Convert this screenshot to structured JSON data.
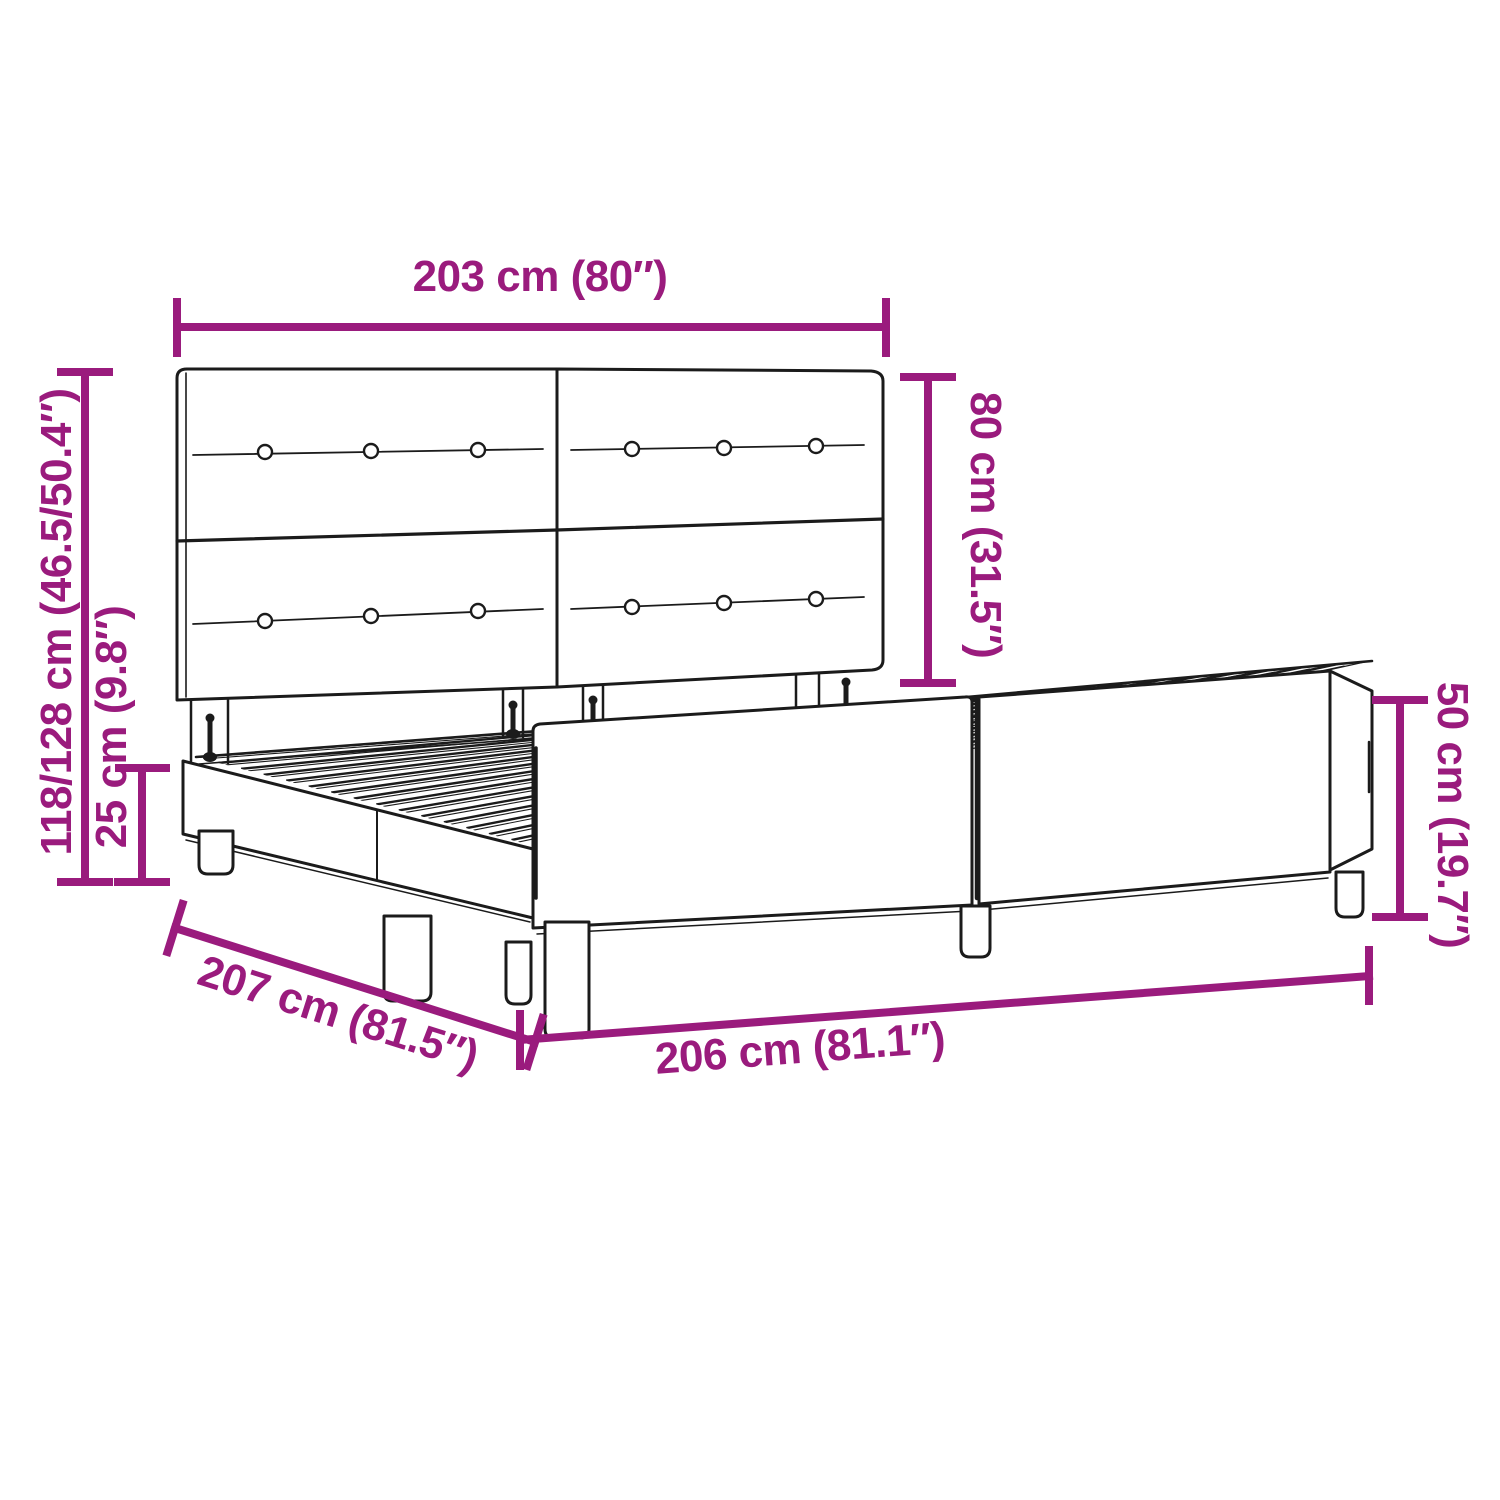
{
  "title": "Bed frame with headboard — dimension diagram",
  "colors": {
    "dimension_accent": "#9A1B7D",
    "line_ink": "#1B1B1B",
    "background": "#FFFFFF"
  },
  "measurements": {
    "headboard_width": {
      "label": "203 cm (80″)",
      "cm": "203",
      "inches": "80"
    },
    "headboard_height": {
      "label": "80 cm (31.5″)",
      "cm": "80",
      "inches": "31.5"
    },
    "overall_height": {
      "label": "118/128 cm (46.5/50.4″)",
      "cm": "118/128",
      "inches": "46.5/50.4"
    },
    "base_frame_height": {
      "label": "25 cm (9.8″)",
      "cm": "25",
      "inches": "9.8"
    },
    "side_panel_height": {
      "label": "50 cm (19.7″)",
      "cm": "50",
      "inches": "19.7"
    },
    "frame_depth": {
      "label": "207 cm (81.5″)",
      "cm": "207",
      "inches": "81.5"
    },
    "frame_length": {
      "label": "206 cm (81.1″)",
      "cm": "206",
      "inches": "81.1"
    }
  }
}
